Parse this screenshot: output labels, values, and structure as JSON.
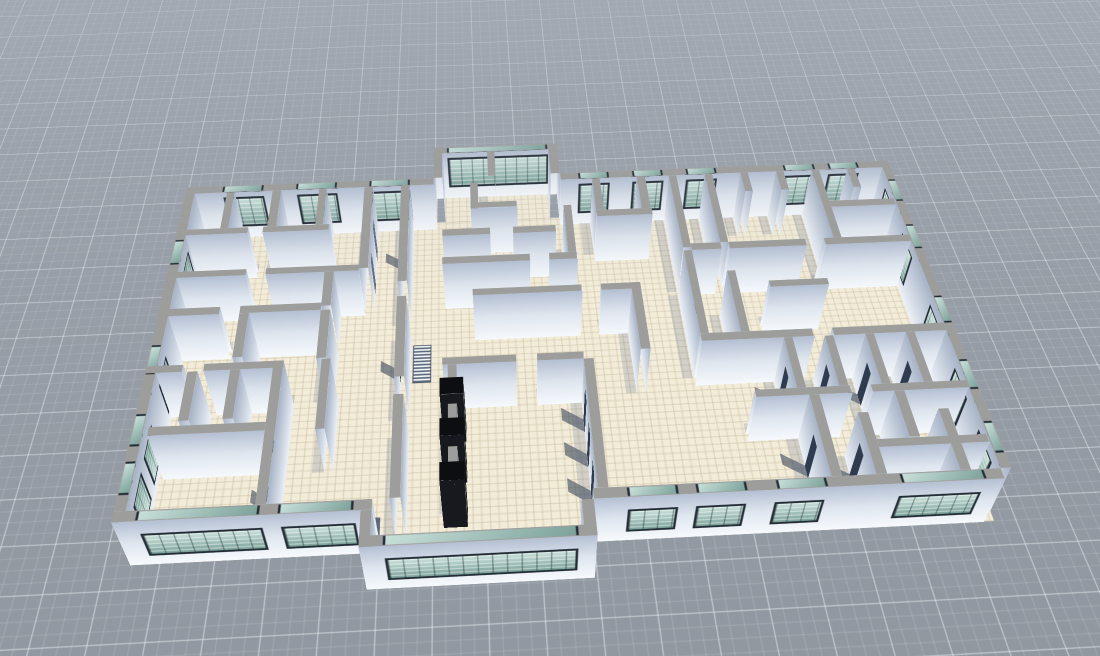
{
  "viewport": {
    "kind": "3d-architectural-floorplan-viewer",
    "chrome_visible": false
  },
  "scene": {
    "camera": {
      "rotate_x_deg": 47,
      "rotate_z_deg": -3.2,
      "perspective_px": 1200,
      "perspective_origin": [
        535,
        170
      ]
    },
    "units": {
      "px_per_unit": 9.5,
      "wall_height_px": 68,
      "origin_px": [
        60,
        75
      ]
    },
    "ground": {
      "far_color": "#a7aeb7",
      "mid_color": "#99a0a9",
      "near_color": "#747b83",
      "grid_major_px": 46,
      "grid_minor_px": 11.5,
      "grid_major_line": "rgba(248,251,255,0.40)",
      "grid_minor_line": "rgba(248,251,255,0.13)"
    },
    "palette": {
      "floor": "#f2ecd9",
      "floor_line": "rgba(186,172,142,0.40)",
      "wall_cap": "#9d9d9b",
      "face_top": "#b4c0d3",
      "face_mid": "#dfe6ef",
      "face_bottom": "#f7fafd",
      "side_light": "#eef2f8",
      "side_dark": "#a6b3c6",
      "glass_light": "#c9e0da",
      "glass_dark": "#7ca29a",
      "frame": "#232d36",
      "door_dark": "#2f3b4f",
      "door_gray": "#646f80",
      "shadow_soft": "rgba(96,110,136,0.22)",
      "shadow_band": "rgba(58,72,99,0.80)",
      "blind_stripe": "rgba(255,255,255,0.55)",
      "cube_black": "#0d0e11"
    },
    "floors": [
      {
        "r": [
          0,
          0,
          78,
          41
        ]
      },
      {
        "r": [
          28,
          -4,
          12,
          4
        ]
      },
      {
        "r": [
          22,
          41,
          18,
          3.4
        ]
      }
    ],
    "walls": [
      {
        "id": "ext-north-left",
        "r": [
          0,
          0,
          27,
          1
        ],
        "win": [
          [
            4,
            8
          ],
          [
            12,
            16
          ],
          [
            20,
            24
          ]
        ],
        "wt": "n"
      },
      {
        "id": "ext-bay-west",
        "r": [
          27,
          -5,
          1,
          5
        ]
      },
      {
        "id": "ext-bay-north",
        "r": [
          27,
          -5,
          14,
          1
        ],
        "win": [
          [
            1.5,
            12.5
          ]
        ],
        "wt": "n"
      },
      {
        "id": "ext-bay-east",
        "r": [
          40,
          -5,
          1,
          5
        ]
      },
      {
        "id": "ext-north-right",
        "r": [
          41,
          0,
          37,
          1
        ],
        "win": [
          [
            2,
            5
          ],
          [
            8,
            11
          ],
          [
            14,
            17
          ],
          [
            25,
            28
          ],
          [
            30,
            33
          ]
        ],
        "wt": "n"
      },
      {
        "id": "ext-east",
        "r": [
          77,
          0,
          1,
          40
        ],
        "winv": [
          [
            3,
            6
          ],
          [
            10,
            13
          ],
          [
            20,
            23
          ],
          [
            28,
            31
          ],
          [
            35,
            38
          ]
        ]
      },
      {
        "id": "ext-west",
        "r": [
          0,
          0,
          1,
          40
        ],
        "winv": [
          [
            8,
            11
          ],
          [
            22,
            25
          ],
          [
            30,
            33
          ],
          [
            35,
            38
          ]
        ]
      },
      {
        "id": "ext-south-left",
        "r": [
          0,
          40,
          22,
          1
        ],
        "win": [
          [
            2,
            12
          ],
          [
            14,
            20
          ]
        ],
        "wt": "s",
        "sband": 1
      },
      {
        "id": "ext-sbay-west",
        "r": [
          21,
          41,
          1,
          3.5
        ]
      },
      {
        "id": "ext-sbay-south",
        "r": [
          21,
          43.5,
          20,
          1
        ],
        "win": [
          [
            2,
            18
          ]
        ],
        "wt": "s",
        "sband": 1
      },
      {
        "id": "ext-sbay-east",
        "r": [
          40,
          41,
          1,
          3.5
        ]
      },
      {
        "id": "ext-south-right",
        "r": [
          41,
          40,
          36,
          1
        ],
        "win": [
          [
            3,
            7
          ],
          [
            9,
            13
          ],
          [
            16,
            20
          ],
          [
            27,
            34
          ]
        ],
        "wt": "s",
        "sband": 1
      },
      {
        "r": [
          4.5,
          1,
          0.9,
          5.5
        ]
      },
      {
        "r": [
          9.5,
          1,
          0.9,
          5.5
        ]
      },
      {
        "r": [
          14.5,
          1,
          0.9,
          5.5
        ]
      },
      {
        "r": [
          0,
          6.5,
          7.5,
          0.9
        ]
      },
      {
        "r": [
          9,
          6.5,
          7,
          0.9
        ]
      },
      {
        "r": [
          19.5,
          1,
          0.9,
          12
        ],
        "de": [
          [
            3,
            1.5,
            "gray"
          ],
          [
            8,
            1.5,
            "gray"
          ]
        ]
      },
      {
        "r": [
          0,
          12.5,
          8,
          0.9
        ]
      },
      {
        "r": [
          10,
          12.5,
          9.5,
          0.9
        ]
      },
      {
        "r": [
          23.5,
          1,
          0.9,
          14
        ],
        "dw": [
          [
            5,
            1.5,
            "gray"
          ]
        ]
      },
      {
        "r": [
          23.5,
          17,
          0.9,
          10
        ],
        "dw": [
          [
            4,
            1.5,
            "dark"
          ]
        ]
      },
      {
        "r": [
          23.5,
          29,
          0.9,
          11
        ]
      },
      {
        "r": [
          0,
          17.5,
          6,
          0.9
        ]
      },
      {
        "r": [
          8,
          17.5,
          8,
          0.9
        ]
      },
      {
        "r": [
          8,
          18.4,
          0.9,
          5.5
        ]
      },
      {
        "r": [
          16,
          13.4,
          0.9,
          4.5
        ]
      },
      {
        "r": [
          16,
          18.4,
          0.9,
          6
        ]
      },
      {
        "r": [
          0,
          24.5,
          3.5,
          0.9
        ]
      },
      {
        "r": [
          5.5,
          24.5,
          7.4,
          0.9
        ]
      },
      {
        "r": [
          12,
          24.5,
          0.9,
          15.5
        ],
        "dw": [
          [
            6,
            1.5,
            "dark"
          ],
          [
            11,
            1.5,
            "dark"
          ]
        ]
      },
      {
        "r": [
          4,
          25.4,
          0.9,
          5.5
        ]
      },
      {
        "r": [
          8,
          25.4,
          0.9,
          5.5
        ]
      },
      {
        "r": [
          1.5,
          31.5,
          10.5,
          0.9
        ]
      },
      {
        "r": [
          16.5,
          24.5,
          0.9,
          8
        ]
      },
      {
        "r": [
          33,
          -4,
          0.9,
          4
        ]
      },
      {
        "r": [
          31,
          1,
          0.9,
          4
        ]
      },
      {
        "r": [
          31,
          4.1,
          5,
          0.9
        ]
      },
      {
        "r": [
          41,
          5,
          0.9,
          7
        ]
      },
      {
        "r": [
          28,
          8,
          5,
          0.9
        ]
      },
      {
        "r": [
          35.5,
          8,
          4.5,
          0.9
        ]
      },
      {
        "r": [
          28,
          12,
          9,
          0.9
        ]
      },
      {
        "r": [
          39,
          12,
          2.9,
          0.9
        ]
      },
      {
        "r": [
          44.5,
          1,
          0.9,
          5
        ]
      },
      {
        "r": [
          49.5,
          1,
          0.9,
          5
        ]
      },
      {
        "r": [
          44.5,
          6,
          6,
          0.9
        ]
      },
      {
        "r": [
          53,
          1,
          0.9,
          11
        ]
      },
      {
        "r": [
          53,
          12.4,
          0.9,
          11.1
        ],
        "de": [
          [
            4,
            1.5,
            "gray"
          ]
        ]
      },
      {
        "r": [
          31,
          16.5,
          11,
          0.9
        ]
      },
      {
        "r": [
          44,
          16.5,
          4,
          0.9
        ]
      },
      {
        "r": [
          47.1,
          16.5,
          0.9,
          8.5
        ]
      },
      {
        "r": [
          28,
          25,
          7,
          0.9
        ]
      },
      {
        "r": [
          37,
          25,
          4.5,
          0.9
        ]
      },
      {
        "r": [
          41.5,
          25.9,
          0.9,
          14.1
        ],
        "dw": [
          [
            2,
            1.6,
            "dark"
          ],
          [
            6,
            1.6,
            "dark"
          ],
          [
            10,
            1.6,
            "dark"
          ]
        ]
      },
      {
        "r": [
          28.5,
          25.9,
          0.9,
          2.6
        ]
      },
      {
        "r": [
          28.5,
          30.4,
          0.9,
          2.6
        ]
      },
      {
        "r": [
          28.5,
          35,
          0.9,
          2.6
        ]
      },
      {
        "r": [
          57,
          1,
          0.9,
          10.5
        ]
      },
      {
        "r": [
          53.9,
          11.5,
          3.2,
          0.9
        ]
      },
      {
        "r": [
          57.9,
          11.5,
          8.1,
          0.9
        ]
      },
      {
        "r": [
          68,
          11.5,
          9,
          0.9
        ]
      },
      {
        "r": [
          61,
          1,
          0.9,
          3
        ]
      },
      {
        "r": [
          65,
          1,
          0.9,
          3
        ]
      },
      {
        "r": [
          69,
          1,
          0.9,
          10.5
        ]
      },
      {
        "r": [
          73,
          1,
          0.9,
          3
        ]
      },
      {
        "r": [
          69.9,
          6,
          7.1,
          0.9
        ]
      },
      {
        "r": [
          57,
          15.5,
          0.9,
          8
        ]
      },
      {
        "r": [
          61,
          17,
          6,
          0.9
        ]
      },
      {
        "r": [
          53,
          23.5,
          11,
          0.9
        ]
      },
      {
        "r": [
          66,
          23.5,
          11,
          0.9
        ]
      },
      {
        "r": [
          61,
          24.4,
          0.9,
          6
        ],
        "dw": [
          [
            2,
            1.4,
            "dark"
          ]
        ]
      },
      {
        "r": [
          65,
          24.4,
          0.9,
          6
        ],
        "dw": [
          [
            2,
            1.4,
            "dark"
          ]
        ]
      },
      {
        "r": [
          69,
          24.4,
          0.9,
          6
        ],
        "dw": [
          [
            2,
            1.4,
            "dark"
          ]
        ]
      },
      {
        "r": [
          73,
          24.4,
          0.9,
          6
        ],
        "dw": [
          [
            2,
            1.4,
            "dark"
          ]
        ]
      },
      {
        "r": [
          57,
          30.4,
          9,
          0.9
        ]
      },
      {
        "r": [
          68,
          30.4,
          9,
          0.9
        ]
      },
      {
        "r": [
          62,
          31.3,
          0.9,
          8.7
        ],
        "dw": [
          [
            3,
            1.4,
            "dark"
          ]
        ]
      },
      {
        "r": [
          66,
          33.5,
          0.9,
          6.5
        ],
        "dw": [
          [
            2,
            1.4,
            "dark"
          ]
        ]
      },
      {
        "r": [
          70,
          31.3,
          0.9,
          5
        ]
      },
      {
        "r": [
          73.5,
          33.5,
          0.9,
          6.5
        ]
      },
      {
        "r": [
          66.9,
          36.4,
          10.1,
          0.9
        ]
      }
    ],
    "cubes": [
      {
        "r": [
          27.8,
          27.9,
          2.2,
          1.9
        ]
      },
      {
        "r": [
          27.8,
          32.4,
          2.2,
          1.9
        ]
      },
      {
        "r": [
          27.8,
          37,
          2.2,
          1.9
        ]
      }
    ],
    "stairs": {
      "r": [
        24.6,
        17.8,
        1.7,
        4.6
      ]
    }
  }
}
